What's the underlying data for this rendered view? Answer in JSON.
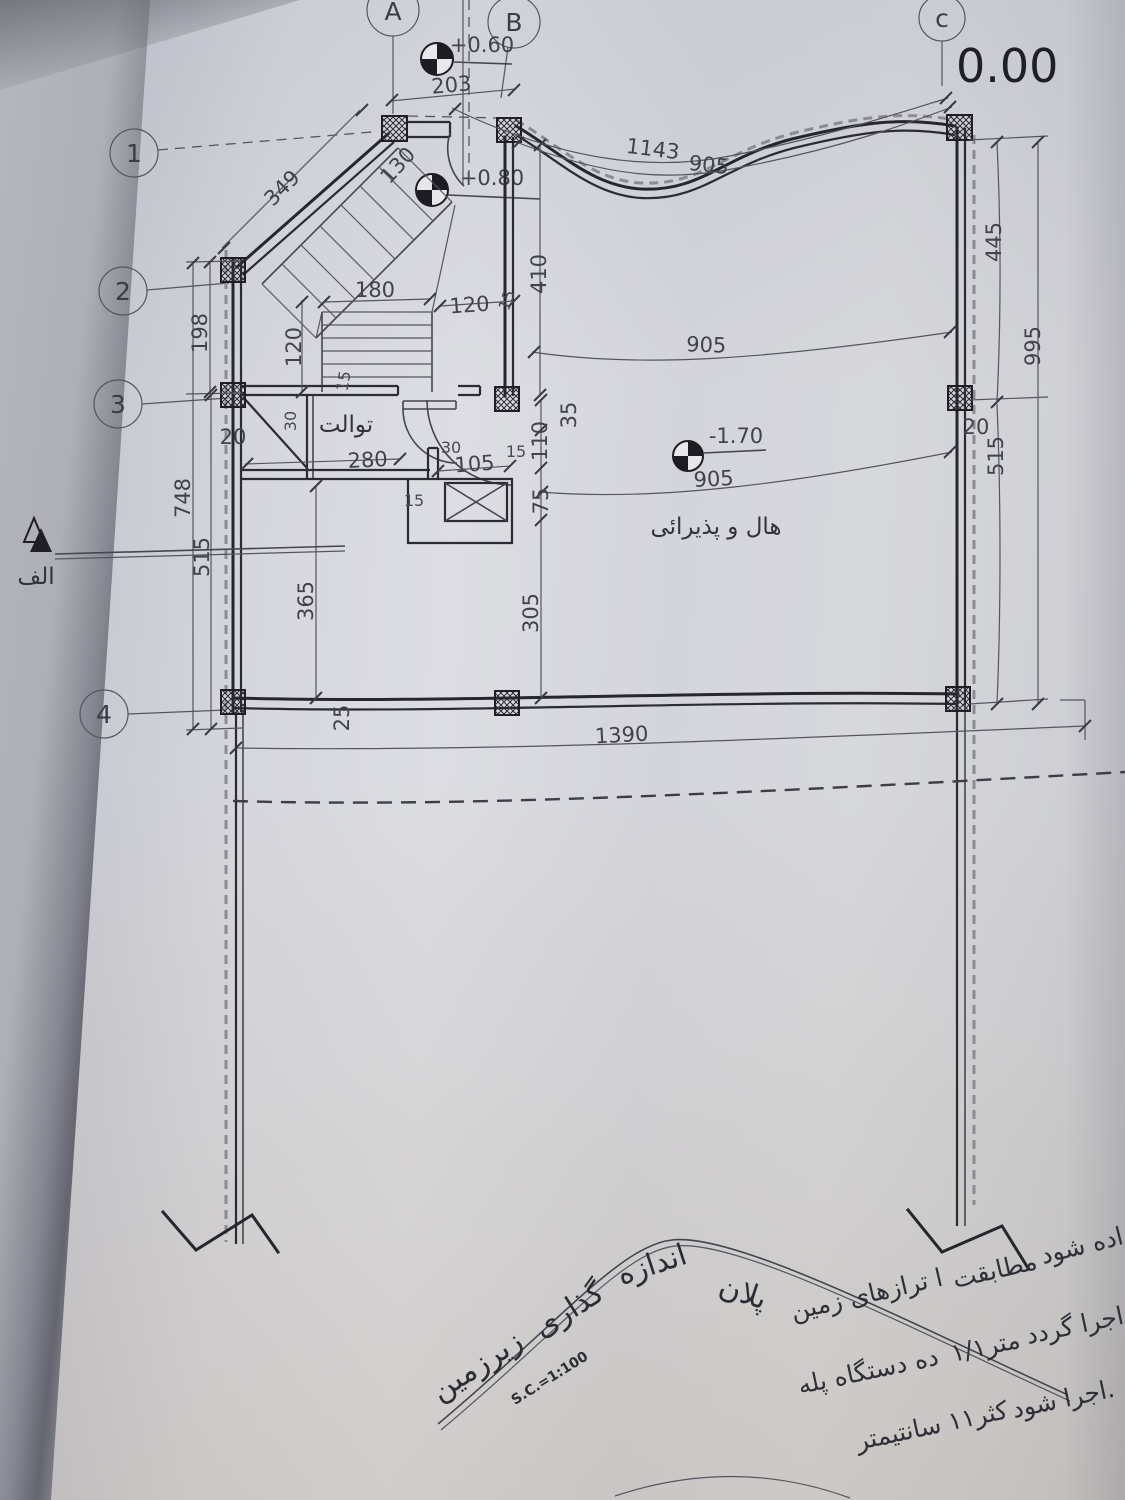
{
  "grid": {
    "a": "A",
    "b": "B",
    "c": "c",
    "r1": "1",
    "r2": "2",
    "r3": "3",
    "r4": "4"
  },
  "levels": {
    "zero": "0.00",
    "plus060": "+0.60",
    "plus080": "+0.80",
    "minus170": "-1.70"
  },
  "dims": {
    "d203": "203",
    "d349": "349",
    "d130": "130",
    "d1143": "1143",
    "d905top": "905",
    "d905mid": "905",
    "d905low": "905",
    "d445": "445",
    "d515r": "515",
    "d995": "995",
    "d20r": "20",
    "d198": "198",
    "d748": "748",
    "d515l": "515",
    "d20l": "20",
    "d365": "365",
    "d305": "305",
    "d75": "75",
    "d110": "110",
    "d35": "35",
    "d410": "410",
    "d15stair": "15",
    "d180": "180",
    "d120h": "120",
    "d120v": "120",
    "d15tread": "15",
    "d280": "280",
    "d30jamb": "30",
    "d30toilet": "30",
    "d105": "105",
    "d15a": "15",
    "d15b": "15",
    "d25": "25",
    "d1390": "1390"
  },
  "rooms": {
    "toilet": "توالت",
    "hall": "هال و پذیرائی"
  },
  "section": {
    "label": "الف"
  },
  "title": {
    "w1": "پلان",
    "w2": "اندازه",
    "w3": "گذاری",
    "w4": "زیرزمین",
    "scale": "S.C.=1:100"
  },
  "notes": {
    "l1a": "ا ترازهای زمین",
    "l1b": "مطابقت",
    "l1c": "داده شود",
    "l2a": "ده دستگاه پله",
    "l2b": "۱/۱متر",
    "l2c": "اجرا گردد.",
    "l3a": "کثر۱۱ سانتیمتر",
    "l3b": "اجرا شود."
  }
}
